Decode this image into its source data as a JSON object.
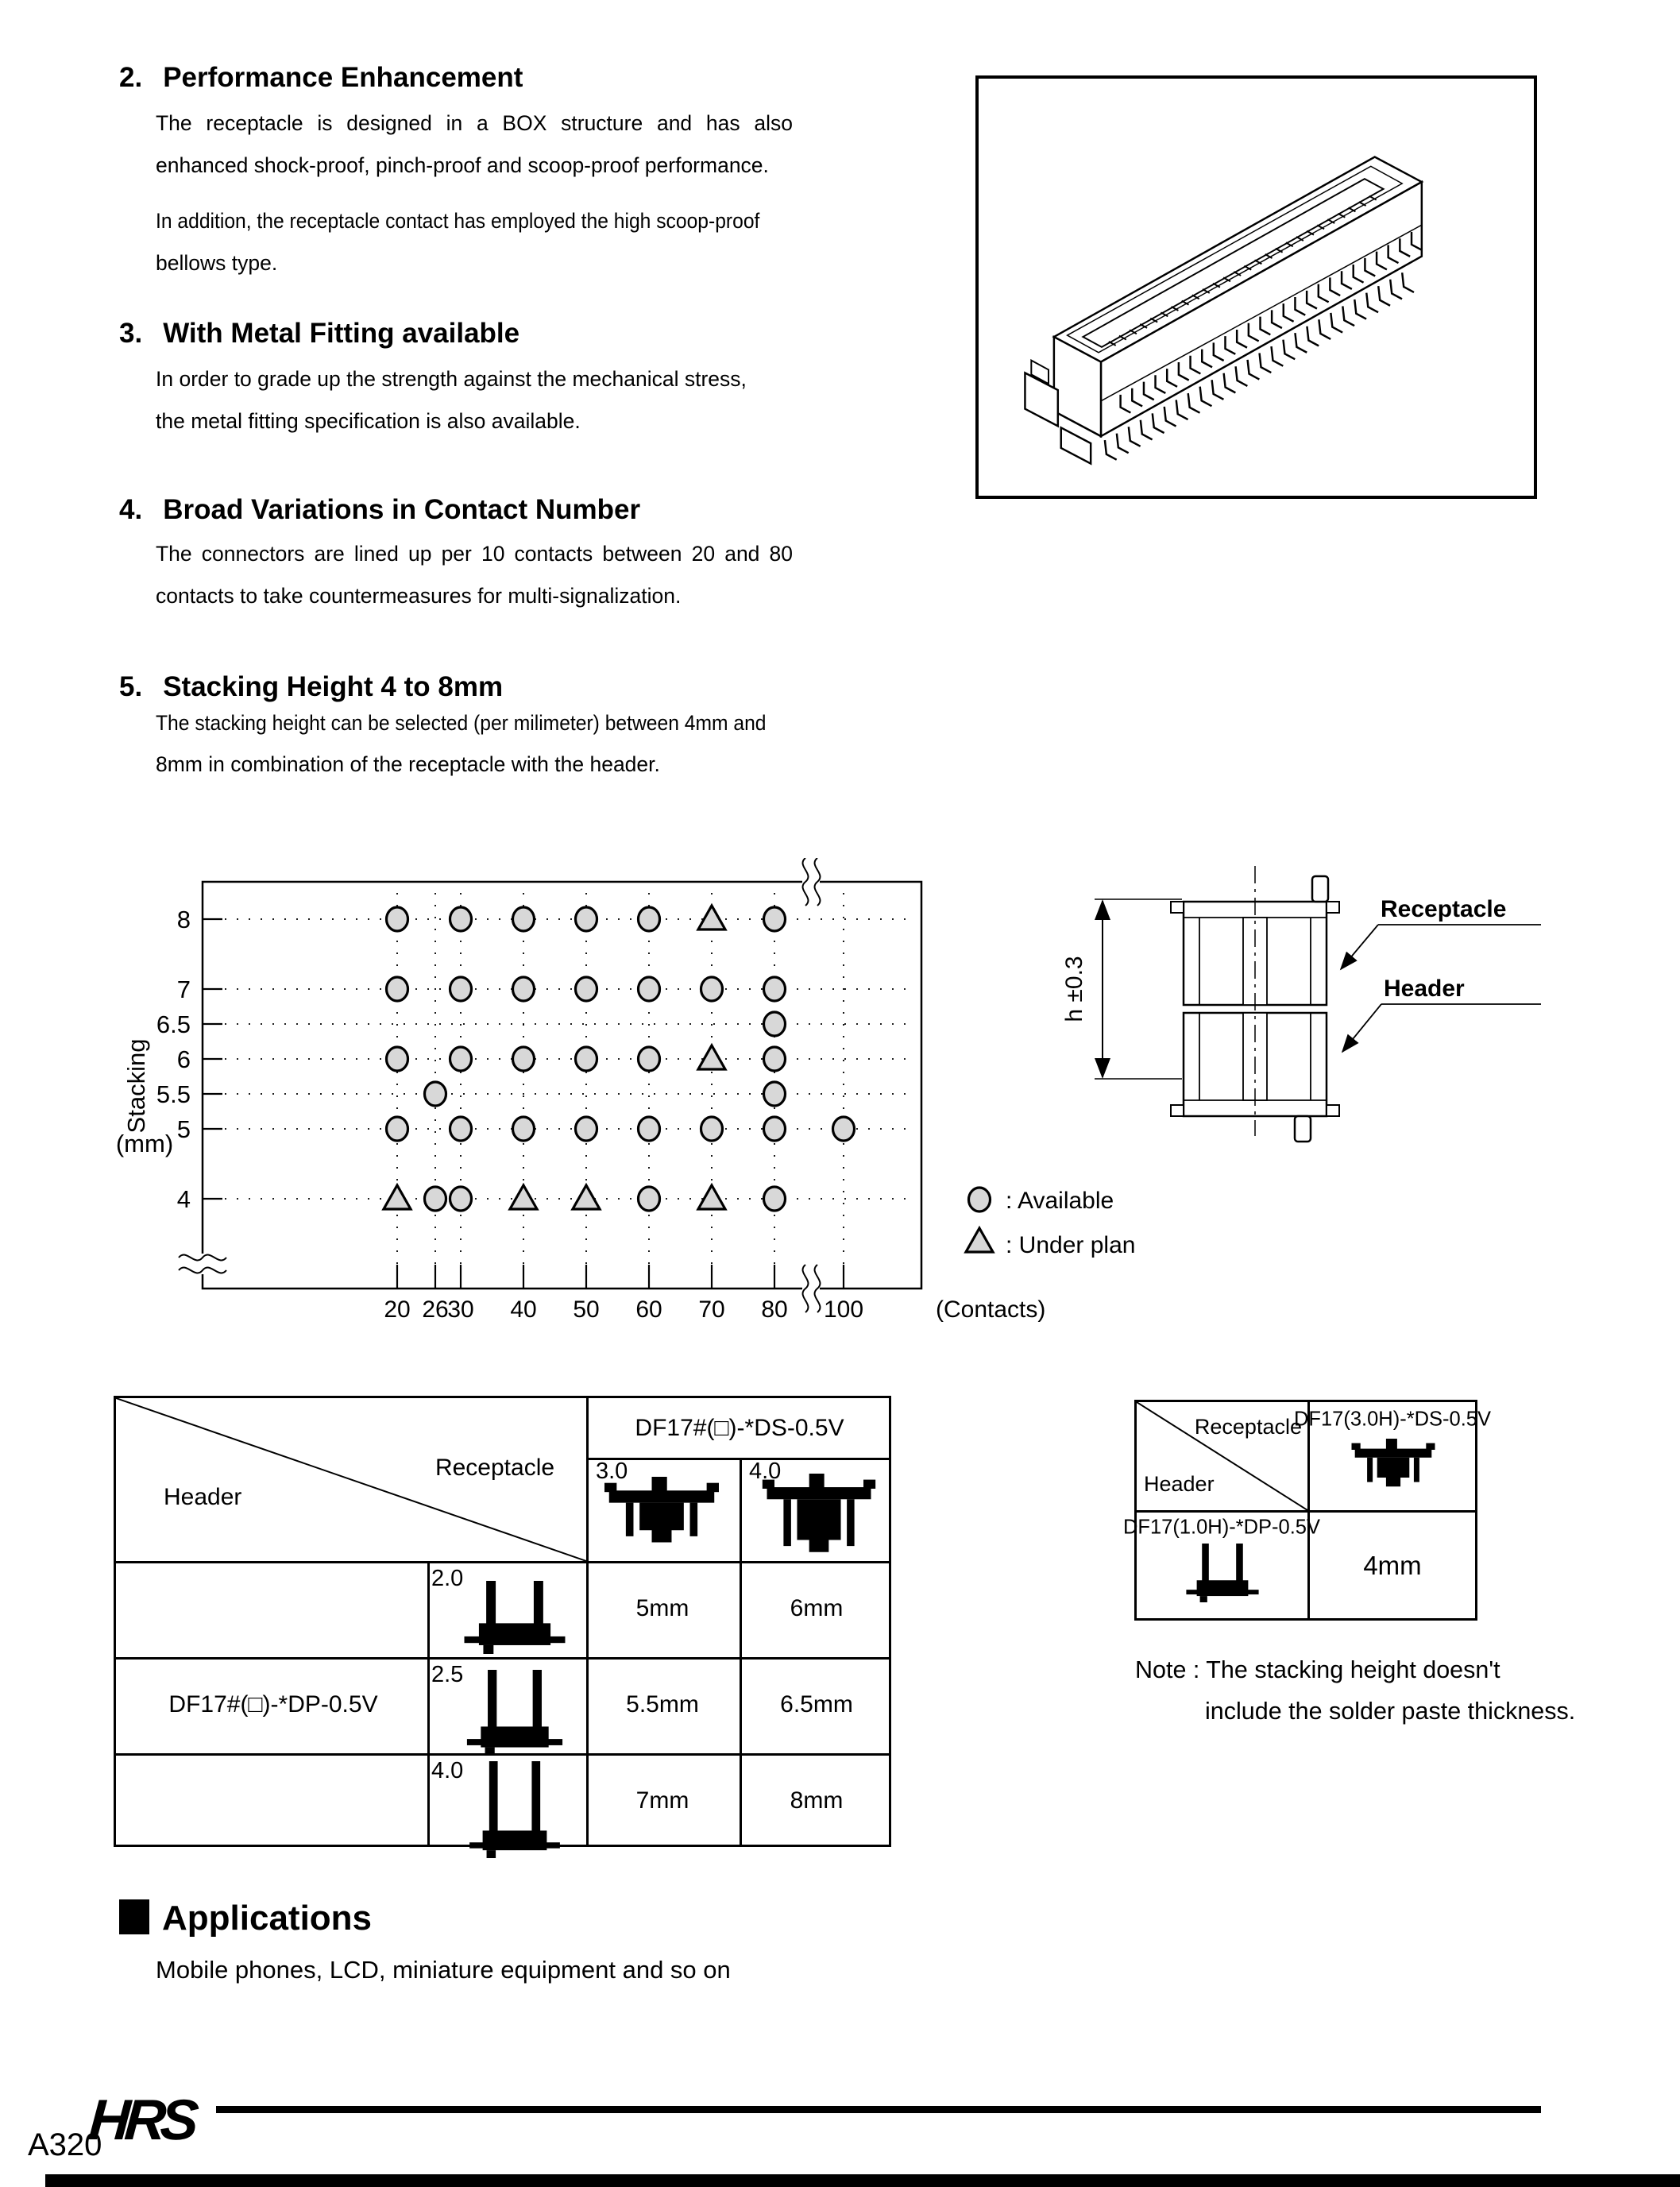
{
  "sections": [
    {
      "number": "2.",
      "title": "Performance Enhancement",
      "para1": [
        "The receptacle is designed in a BOX structure and has also",
        "enhanced shock-proof, pinch-proof and scoop-proof performance."
      ],
      "para2": [
        "In addition, the receptacle contact has employed the high scoop-proof",
        "bellows type."
      ]
    },
    {
      "number": "3.",
      "title": "With Metal Fitting available",
      "para1": [
        "In order to grade up the strength against the mechanical stress,",
        "the metal fitting specification is also available."
      ]
    },
    {
      "number": "4.",
      "title": "Broad Variations in Contact Number",
      "para1": [
        "The connectors are lined up per 10 contacts between 20 and 80",
        "contacts to take countermeasures for multi-signalization."
      ]
    },
    {
      "number": "5.",
      "title": "Stacking Height 4 to 8mm",
      "para1": [
        "The stacking height can be selected (per milimeter) between 4mm and",
        "8mm in combination of the receptacle with the header."
      ]
    }
  ],
  "chart_data": {
    "type": "scatter",
    "xlabel": "(Contacts)",
    "ylabel": "Stacking",
    "ylabel_unit": "(mm)",
    "x_ticks": [
      "20",
      "26",
      "30",
      "40",
      "50",
      "60",
      "70",
      "80",
      "100"
    ],
    "y_ticks": [
      "8",
      "7",
      "6.5",
      "6",
      "5.5",
      "5",
      "4"
    ],
    "x_axis_break": "between 80 and 100",
    "grid": "dotted",
    "legend": [
      {
        "symbol": "circle",
        "label": ": Available"
      },
      {
        "symbol": "triangle",
        "label": ": Under plan"
      }
    ],
    "series": [
      {
        "name": "Available",
        "symbol": "circle",
        "points": [
          [
            20,
            8
          ],
          [
            30,
            8
          ],
          [
            40,
            8
          ],
          [
            50,
            8
          ],
          [
            60,
            8
          ],
          [
            80,
            8
          ],
          [
            20,
            7
          ],
          [
            30,
            7
          ],
          [
            40,
            7
          ],
          [
            50,
            7
          ],
          [
            60,
            7
          ],
          [
            70,
            7
          ],
          [
            80,
            7
          ],
          [
            80,
            6.5
          ],
          [
            20,
            6
          ],
          [
            30,
            6
          ],
          [
            40,
            6
          ],
          [
            50,
            6
          ],
          [
            60,
            6
          ],
          [
            80,
            6
          ],
          [
            26,
            5.5
          ],
          [
            80,
            5.5
          ],
          [
            20,
            5
          ],
          [
            30,
            5
          ],
          [
            40,
            5
          ],
          [
            50,
            5
          ],
          [
            60,
            5
          ],
          [
            70,
            5
          ],
          [
            80,
            5
          ],
          [
            100,
            5
          ],
          [
            26,
            4
          ],
          [
            30,
            4
          ],
          [
            60,
            4
          ],
          [
            80,
            4
          ]
        ]
      },
      {
        "name": "Under plan",
        "symbol": "triangle",
        "points": [
          [
            70,
            8
          ],
          [
            70,
            6
          ],
          [
            20,
            4
          ],
          [
            40,
            4
          ],
          [
            50,
            4
          ],
          [
            70,
            4
          ]
        ]
      }
    ]
  },
  "cross_section": {
    "dim_label": "h ±0.3",
    "receptacle_label": "Receptacle",
    "header_label": "Header"
  },
  "combination_table": {
    "corner_receptacle": "Receptacle",
    "corner_header": "Header",
    "receptacle_part": "DF17#(□)-*DS-0.5V",
    "receptacle_heights": [
      "3.0",
      "4.0"
    ],
    "header_part": "DF17#(□)-*DP-0.5V",
    "rows": [
      {
        "header_height": "2.0",
        "values": [
          "5mm",
          "6mm"
        ]
      },
      {
        "header_height": "2.5",
        "values": [
          "5.5mm",
          "6.5mm"
        ]
      },
      {
        "header_height": "4.0",
        "values": [
          "7mm",
          "8mm"
        ]
      }
    ]
  },
  "mini_table": {
    "corner_receptacle": "Receptacle",
    "corner_header": "Header",
    "receptacle_part": "DF17(3.0H)-*DS-0.5V",
    "header_part": "DF17(1.0H)-*DP-0.5V",
    "stacking_value": "4mm"
  },
  "note_lines": [
    "Note : The stacking height doesn't",
    "include the solder paste thickness."
  ],
  "applications": {
    "title": "Applications",
    "body": "Mobile phones, LCD, miniature equipment and so on"
  },
  "footer": {
    "page_code": "A320",
    "logo_text": "HRS"
  },
  "colors": {
    "ink": "#000000",
    "paper": "#ffffff",
    "symbol_fill": "#d8d8d8"
  }
}
